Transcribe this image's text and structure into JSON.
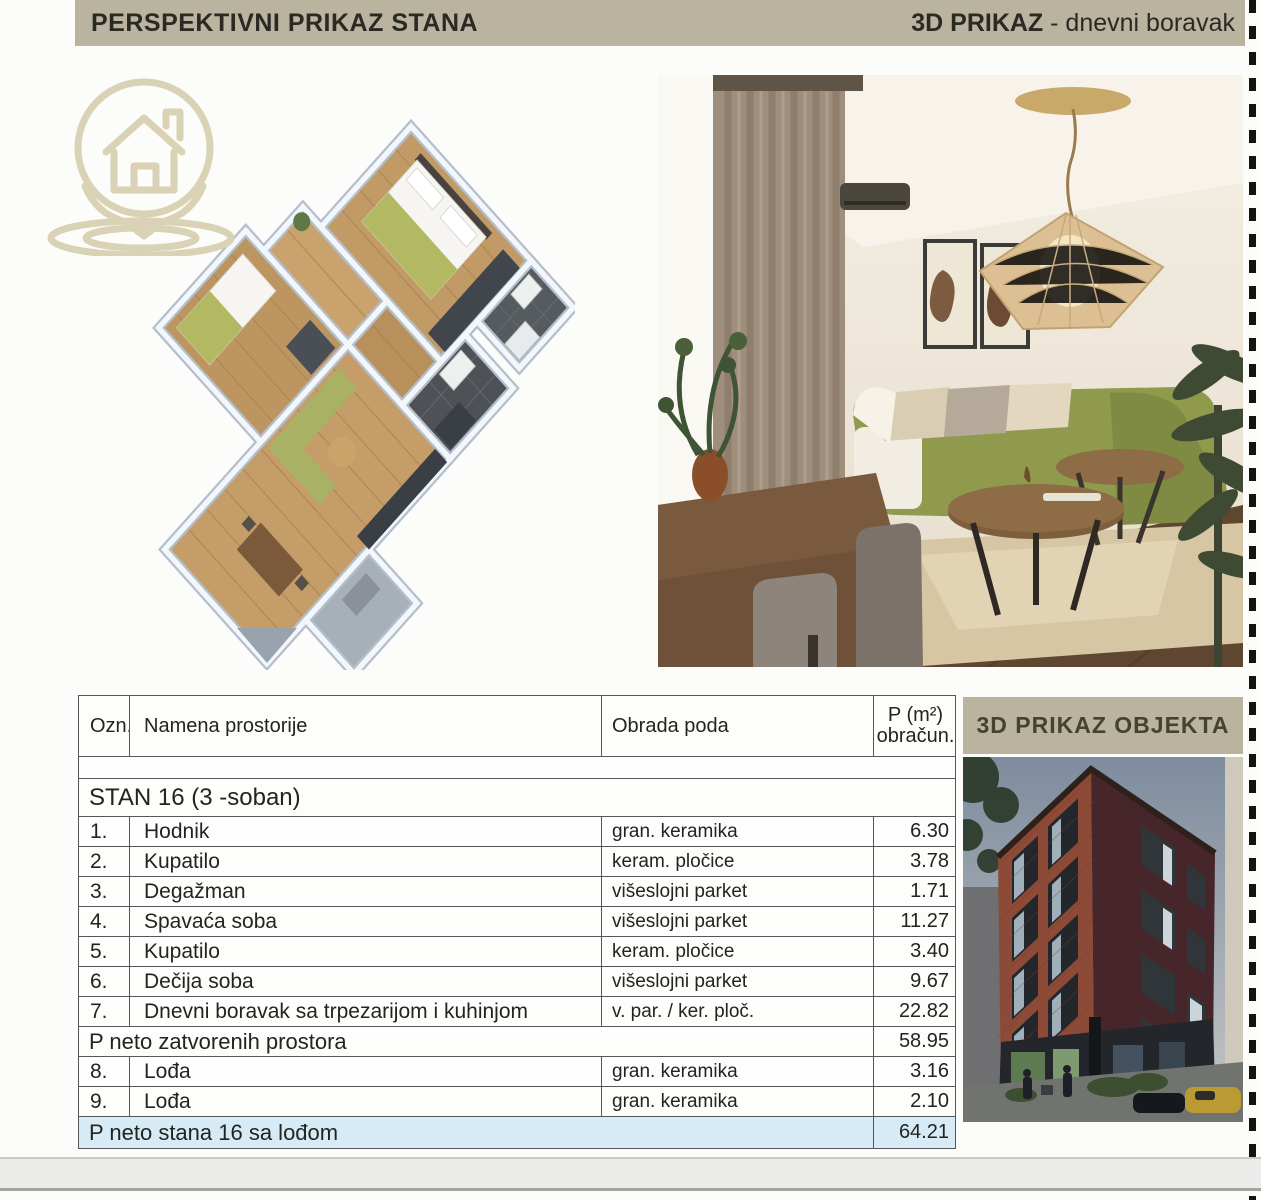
{
  "header": {
    "left_title": "PERSPEKTIVNI PRIKAZ STANA",
    "right_title_bold": "3D PRIKAZ",
    "right_title_rest": " - dnevni boravak"
  },
  "panel": {
    "title": "3D PRIKAZ OBJEKTA"
  },
  "icons": {
    "logo": "house-location-pin"
  },
  "colors": {
    "band_beige": "#b9b3a0",
    "highlight_blue": "#d7ebf6",
    "logo_tan": "#d9d2b4"
  },
  "table": {
    "headers": {
      "ozn": "Ozn.",
      "name": "Namena prostorije",
      "floor": "Obrada poda",
      "area_top": "P (m²)",
      "area_bottom": "obračun."
    },
    "group_title": "STAN 16  (3 -soban)",
    "rows": [
      {
        "num": "1.",
        "name": "Hodnik",
        "floor": "gran. keramika",
        "area": "6.30"
      },
      {
        "num": "2.",
        "name": "Kupatilo",
        "floor": "keram. pločice",
        "area": "3.78"
      },
      {
        "num": "3.",
        "name": "Degažman",
        "floor": "višeslojni parket",
        "area": "1.71"
      },
      {
        "num": "4.",
        "name": "Spavaća soba",
        "floor": "višeslojni parket",
        "area": "11.27"
      },
      {
        "num": "5.",
        "name": "Kupatilo",
        "floor": "keram. pločice",
        "area": "3.40"
      },
      {
        "num": "6.",
        "name": "Dečija soba",
        "floor": "višeslojni parket",
        "area": "9.67"
      },
      {
        "num": "7.",
        "name": "Dnevni boravak sa trpezarijom i kuhinjom",
        "floor": "v. par. / ker. ploč.",
        "area": "22.82"
      }
    ],
    "subtotal": {
      "label": "P neto zatvorenih prostora",
      "area": "58.95"
    },
    "rows_open": [
      {
        "num": "8.",
        "name": "Lođa",
        "floor": "gran. keramika",
        "area": "3.16"
      },
      {
        "num": "9.",
        "name": "Lođa",
        "floor": "gran. keramika",
        "area": "2.10"
      }
    ],
    "total": {
      "label": "P neto stana 16 sa lođom",
      "area": "64.21"
    }
  }
}
